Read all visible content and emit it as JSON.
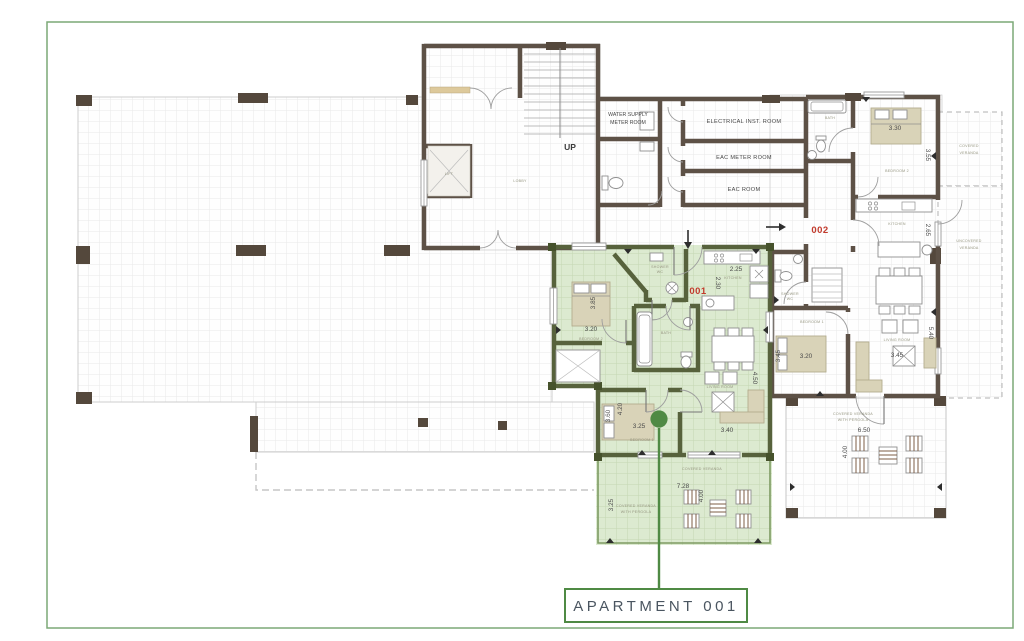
{
  "colors": {
    "accent_green": "#4f8a44",
    "highlight_fill": "#dcead0",
    "wall_brown": "#5d5146",
    "wall_green": "#57623c",
    "label_red": "#c23a2c",
    "frame_green": "#7ca877"
  },
  "callout": {
    "label": "APARTMENT 001"
  },
  "core": {
    "up": "UP",
    "lift": "LIFT",
    "lobby": "LOBBY",
    "water1": "WATER SUPPLY",
    "water2": "METER ROOM",
    "electrical": "ELECTRICAL INST. ROOM",
    "eac_meter": "EAC METER ROOM",
    "eac": "EAC ROOM"
  },
  "apt001": {
    "id": "001",
    "bedroom2": {
      "name": "BEDROOM 2",
      "w": "3.20",
      "h": "3.85"
    },
    "shower": {
      "name1": "SHOWER",
      "name2": "WC"
    },
    "bath": {
      "name": "BATH"
    },
    "kitchen": {
      "name": "KITCHEN",
      "w": "2.25",
      "h": "2.30"
    },
    "living": {
      "name": "LIVING ROOM",
      "w": "3.40",
      "h": "4.50"
    },
    "bedroom1": {
      "name": "BEDROOM 1",
      "w": "3.25",
      "d1": "3.60",
      "d2": "4.20"
    },
    "veranda": {
      "name": "COVERED VERANDA",
      "w": "7.28",
      "h": "4.00"
    },
    "pergola": {
      "name1": "COVERED VERANDA",
      "name2": "WITH PERGOLA",
      "h": "3.25"
    }
  },
  "apt002": {
    "id": "002",
    "bath": {
      "name": "BATH"
    },
    "bedroom2": {
      "name": "BEDROOM 2",
      "w": "3.30",
      "h": "3.55"
    },
    "kitchen": {
      "name": "KITCHEN",
      "h": "2.65"
    },
    "shower": {
      "name1": "SHOWER",
      "name2": "WC"
    },
    "bedroom1": {
      "name": "BEDROOM 1",
      "w": "3.20",
      "h": "3.45"
    },
    "living": {
      "name": "LIVING ROOM",
      "w": "3.45",
      "h": "5.40"
    },
    "covered_veranda": {
      "name1": "COVERED",
      "name2": "VERANDA"
    },
    "uncovered_veranda": {
      "name1": "UNCOVERED",
      "name2": "VERANDA"
    },
    "pergola": {
      "name1": "COVERED VERANDA",
      "name2": "WITH PERGOLA",
      "w": "6.50",
      "h": "4.00"
    }
  }
}
